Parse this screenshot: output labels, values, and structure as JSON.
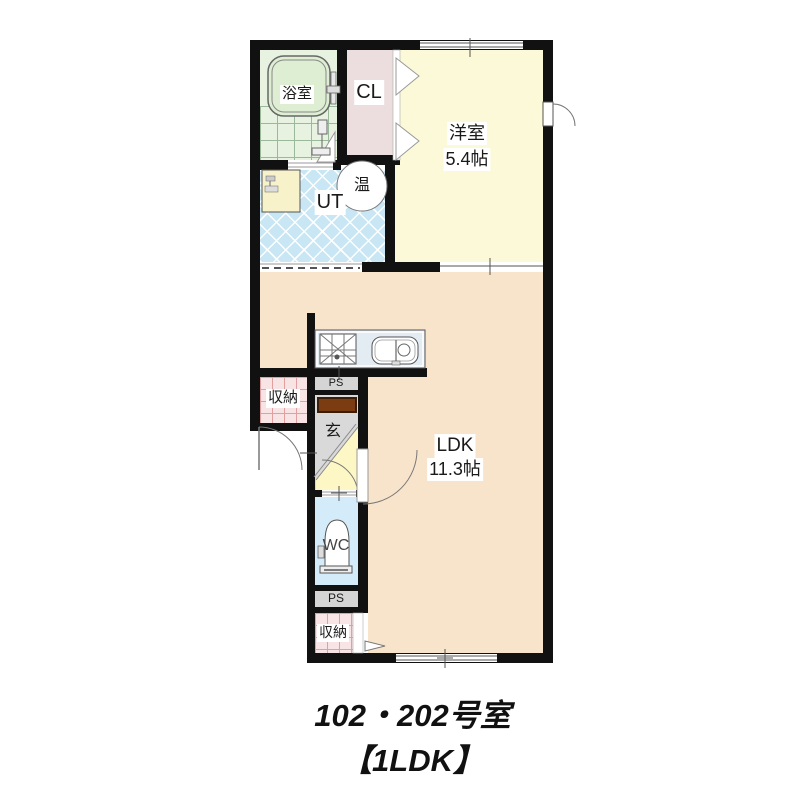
{
  "title": {
    "line1": "102・202号室",
    "line2": "【1LDK】"
  },
  "rooms": {
    "bathroom": {
      "label": "浴室"
    },
    "closet_cl": {
      "label": "CL"
    },
    "western_room": {
      "label": "洋室",
      "size": "5.4帖"
    },
    "utility": {
      "label": "UT"
    },
    "water_heater": {
      "label": "温"
    },
    "ldk": {
      "label": "LDK",
      "size": "11.3帖"
    },
    "storage_mid": {
      "label": "収納"
    },
    "storage_bottom": {
      "label": "収納"
    },
    "entrance": {
      "label": "玄"
    },
    "wc": {
      "label": "WC"
    },
    "pipe_space_upper": {
      "label": "PS"
    },
    "pipe_space_lower": {
      "label": "PS"
    }
  },
  "fixtures": [
    "bathtub",
    "shower",
    "washbasin",
    "water-heater",
    "kitchen-stove",
    "kitchen-sink",
    "toilet",
    "entry-door",
    "closet-doors",
    "windows"
  ],
  "colors": {
    "wall": "#111111",
    "bathroom": "#e7f3e0",
    "closet_cl": "#ecdede",
    "western_room": "#fbf9d8",
    "utility": "#c9e6f4",
    "ldk": "#f8e3cb",
    "entrance_floor": "#d9d9d9",
    "hall_floor": "#fdf7c5",
    "wc": "#d4ecf9",
    "storage": "#f8e4e4",
    "pipe_space": "#d5d5d5",
    "entrance_mat": "#7a3c10"
  }
}
